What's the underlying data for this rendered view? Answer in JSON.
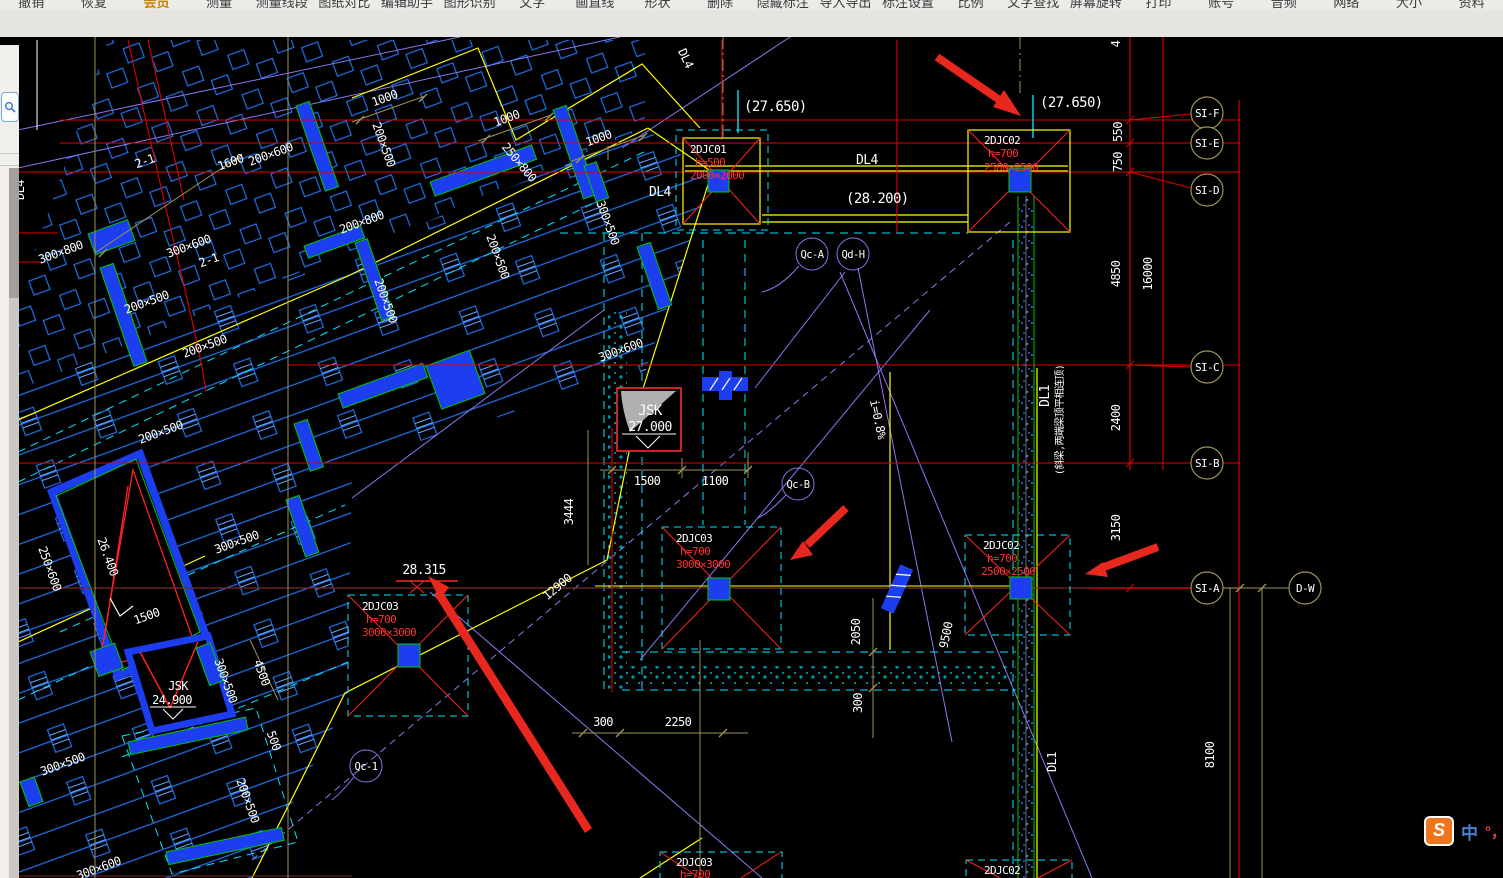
{
  "menu": {
    "items": [
      "撤销",
      "恢复",
      "会员",
      "测量",
      "测量线段",
      "图纸对比",
      "编辑助手",
      "图形识别",
      "文字",
      "画直线",
      "形状",
      "删除",
      "隐藏标注",
      "导入导出",
      "标注设置",
      "比例",
      "文字查找",
      "屏幕旋转",
      "打印",
      "账号",
      "音频",
      "网络",
      "大小",
      "资料"
    ]
  },
  "tabs": {
    "close": "×",
    "items": [
      {
        "label": "11#承台平面布置图"
      },
      {
        "label": "10#承台平面布置图"
      },
      {
        "label": "地下室基础底板配筋···"
      },
      {
        "label": "地下室基础底板平面图"
      },
      {
        "label": "地下室基础底板配···"
      }
    ]
  },
  "drawing": {
    "levels": {
      "top_center": "(27.650)",
      "top_right": "(27.650)",
      "mid": "(28.200)",
      "spot": "28.315"
    },
    "beams": {
      "dl4_top": "DL4",
      "dl4_left": "DL4",
      "dl1_right": "DL1",
      "dl1_note": "(斜梁,两端梁顶平相连顶)",
      "dl1_bottom": "DL1"
    },
    "caps": {
      "c01": {
        "name": "2DJC01",
        "h": "h=500",
        "size": "2000×2000"
      },
      "c02a": {
        "name": "2DJC02",
        "h": "h=700",
        "size": "2500×2500"
      },
      "c02b": {
        "name": "2DJC02",
        "h": "h=700",
        "size": "2500×2500"
      },
      "c02c": {
        "name": "2DJC02"
      },
      "c03a": {
        "name": "2DJC03",
        "h": "h=700",
        "size": "3000×3000"
      },
      "c03b": {
        "name": "2DJC03",
        "h": "h=700",
        "size": "3000×3000"
      },
      "c03c": {
        "name": "2DJC03",
        "h": "h=700"
      }
    },
    "jsk": {
      "a_name": "JSK",
      "a_elev": "27.000",
      "b_name": "JSK",
      "b_elev": "24.900"
    },
    "axes": {
      "f": "SI-F",
      "e": "SI-E",
      "d": "SI-D",
      "c": "SI-C",
      "b": "SI-B",
      "a": "SI-A",
      "dw": "D-W"
    },
    "vdims": {
      "d4": "4",
      "d550": "550",
      "d750": "750",
      "d4850": "4850",
      "d16000": "16000",
      "d2400": "2400",
      "d3150": "3150",
      "d8100": "8100"
    },
    "dims": {
      "d1500": "1500",
      "d1100": "1100",
      "d3444": "3444",
      "d300a": "300",
      "d2250": "2250",
      "d2050": "2050",
      "d300b": "300",
      "d9500": "9500",
      "d12900": "12900",
      "slope": "i=0.8%"
    },
    "marks": {
      "qca": "Qc-A",
      "qdh": "Qd-H",
      "qcb": "Qc-B",
      "qc1": "Qc-1"
    },
    "bldg": [
      "300×800",
      "300×600",
      "2-1",
      "1600",
      "200×600",
      "200×500",
      "200×500",
      "1000",
      "1000",
      "1000",
      "200×500",
      "250×800",
      "300×500",
      "200×800",
      "200×500",
      "200×500",
      "300×600",
      "200×500",
      "300×500",
      "250×600",
      "26.400",
      "1500",
      "4500",
      "300×500",
      "300×500",
      "500",
      "200×500",
      "300×600",
      "2-1",
      "DL4",
      "DL4"
    ]
  },
  "ime": {
    "badge": "S",
    "zh": "中",
    "punct": "°，"
  }
}
